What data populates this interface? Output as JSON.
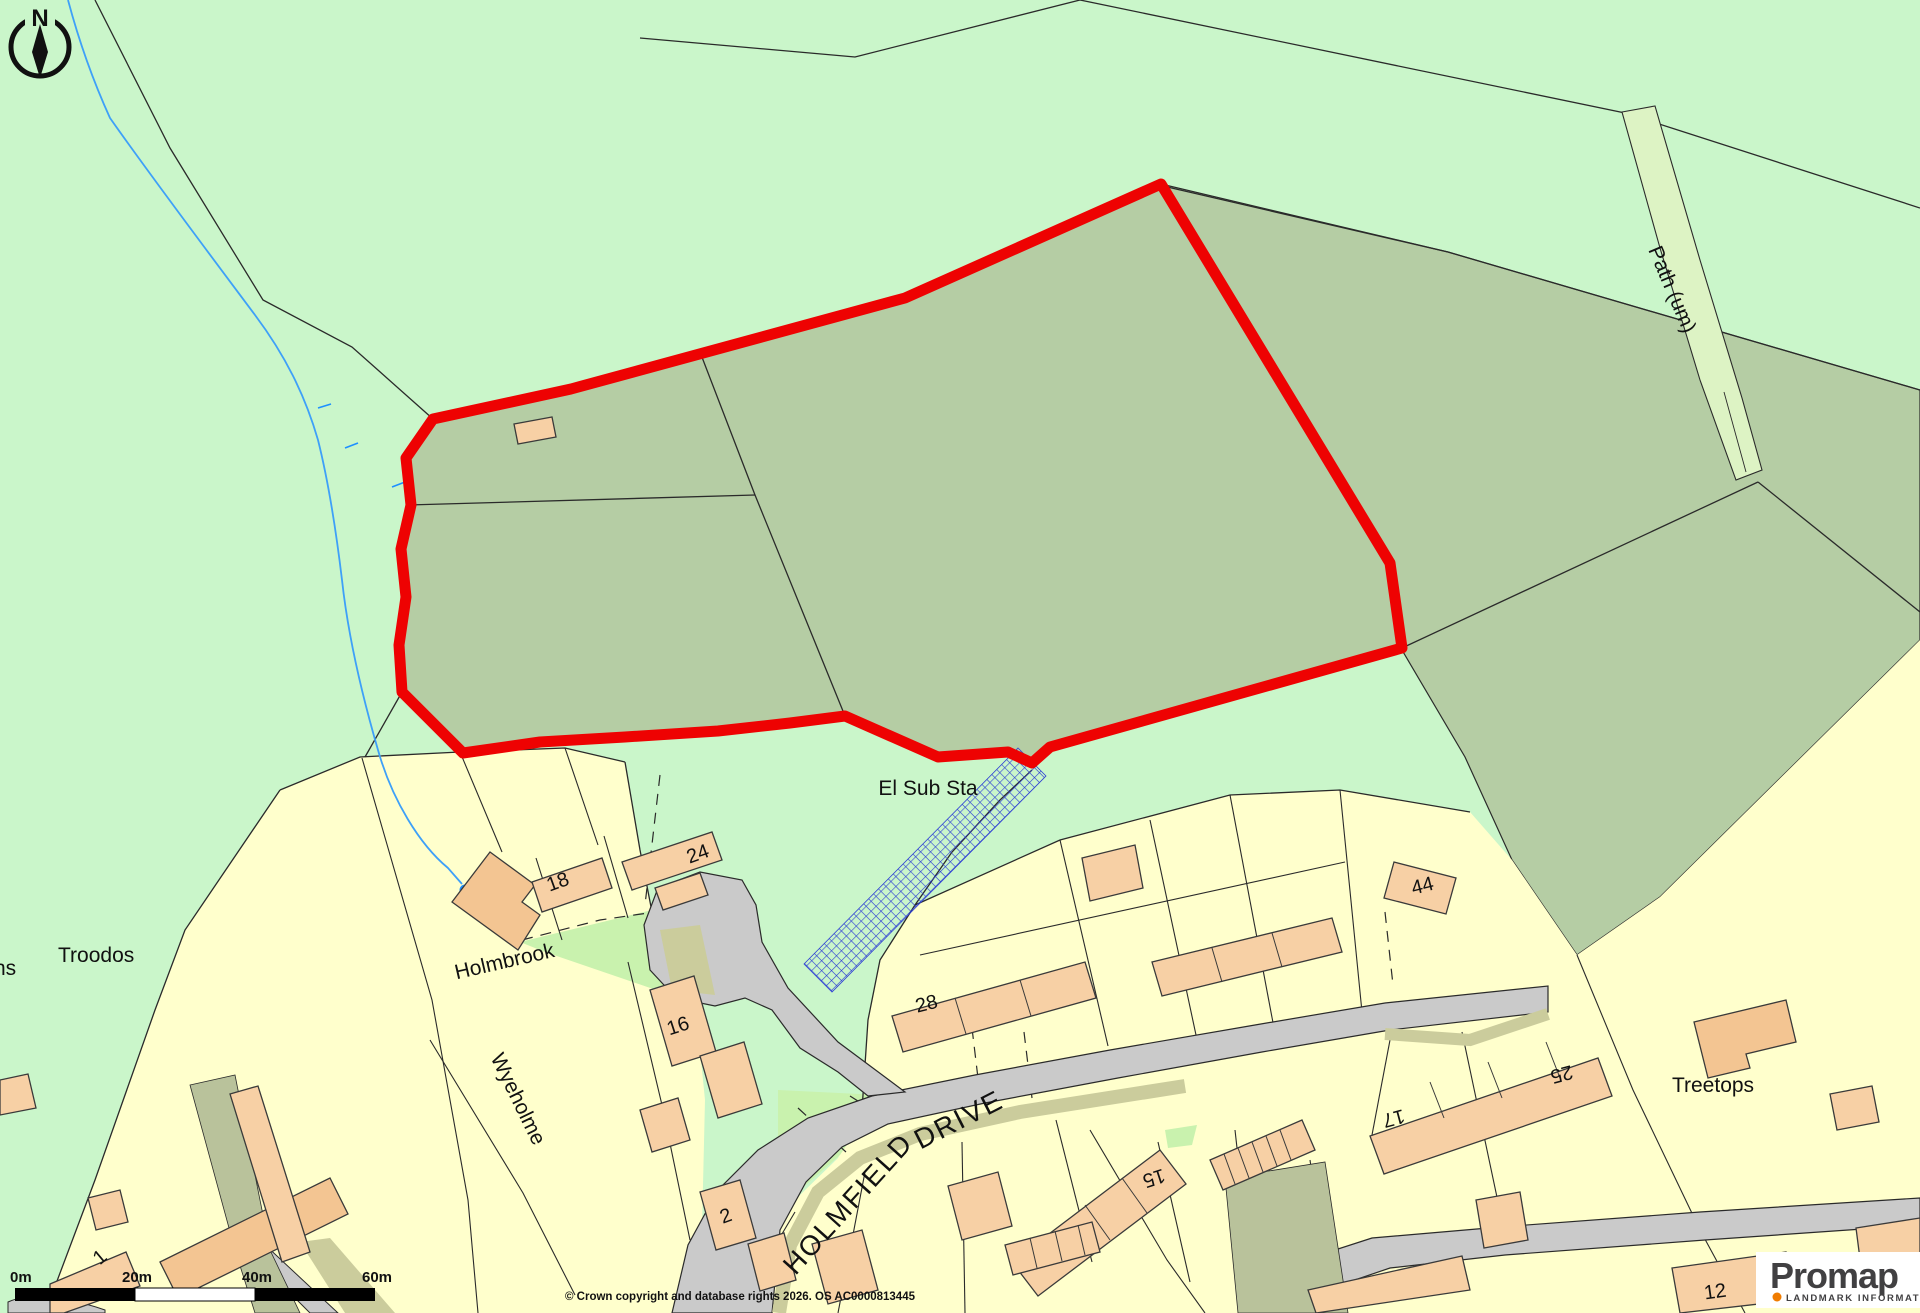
{
  "compass": {
    "north": "N"
  },
  "scale_bar": {
    "ticks": [
      "0m",
      "20m",
      "40m",
      "60m"
    ]
  },
  "labels": {
    "troodos": "Troodos",
    "left_fragment": "ns",
    "wyeholme": "Wyeholme",
    "holmbrook": "Holmbrook",
    "el_sub_sta": "El Sub Sta",
    "treetops": "Treetops",
    "path_um": "Path (um)",
    "street_holmfield": "HOLMFIELD",
    "street_drive": "DRIVE"
  },
  "house_numbers": {
    "h1": "1",
    "h2": "2",
    "h12": "12",
    "h15": "15",
    "h16": "16",
    "h17": "17",
    "h18": "18",
    "h24": "24",
    "h25": "25",
    "h28": "28",
    "h44": "44"
  },
  "copyright": "© Crown copyright and database rights 2026. OS AC0000813445",
  "logo": {
    "brand": "Promap",
    "tagline": "LANDMARK INFORMATION"
  },
  "colors": {
    "boundary_red": "#ee0202",
    "field_pale_green": "#caf6ca",
    "field_sage_green": "#b5cda4",
    "residential_yellow": "#ffffcc",
    "building_peach": "#f7d0a5",
    "road_grey": "#cacaca",
    "verge_khaki": "#cbcc9c",
    "olive_block": "#b9c29b",
    "path_strip_green": "#ddf3c4",
    "verge_green": "#c9f2ae",
    "water_blue": "#1e90ff",
    "hatch_blue": "#2d3fd4",
    "logo_orange": "#f07c00"
  }
}
